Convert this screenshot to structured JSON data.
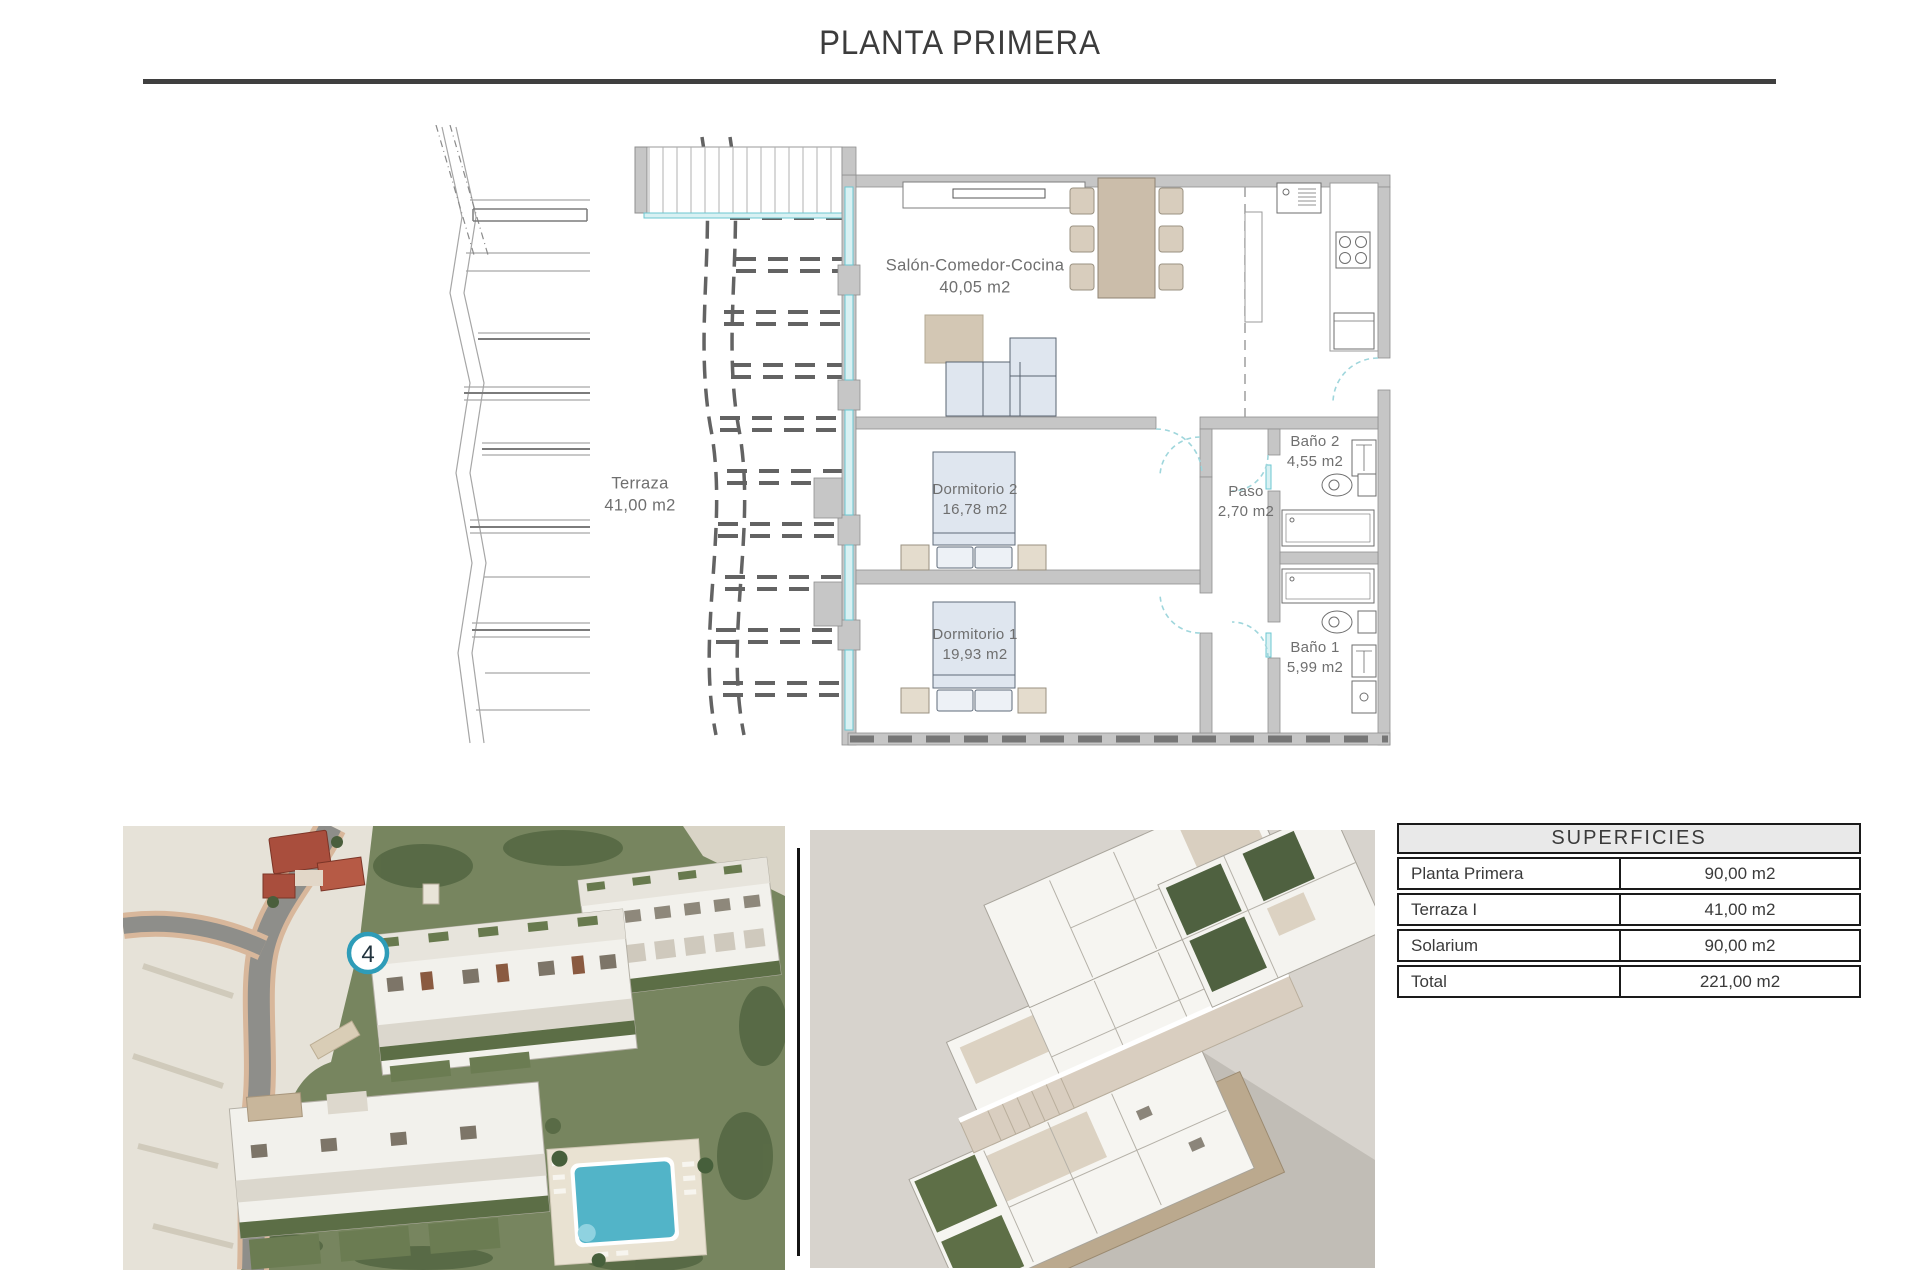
{
  "page": {
    "title": "PLANTA PRIMERA"
  },
  "floor_plan": {
    "rooms": [
      {
        "name": "Terraza",
        "area": "41,00 m2"
      },
      {
        "name": "Salón-Comedor-Cocina",
        "area": "40,05 m2"
      },
      {
        "name": "Dormitorio 2",
        "area": "16,78 m2"
      },
      {
        "name": "Dormitorio 1",
        "area": "19,93 m2"
      },
      {
        "name": "Paso",
        "area": "2,70 m2"
      },
      {
        "name": "Baño 2",
        "area": "4,55 m2"
      },
      {
        "name": "Baño 1",
        "area": "5,99 m2"
      }
    ]
  },
  "site_photo": {
    "unit_marker": "4"
  },
  "surfaces_table": {
    "header": "SUPERFICIES",
    "rows": [
      {
        "label": "Planta Primera",
        "value": "90,00 m2"
      },
      {
        "label": "Terraza I",
        "value": "41,00 m2"
      },
      {
        "label": "Solarium",
        "value": "90,00 m2"
      },
      {
        "label": "Total",
        "value": "221,00 m2"
      }
    ]
  },
  "colors": {
    "title_text": "#3c3c3c",
    "title_rule": "#3f3f3f",
    "wall_gray": "#c6c6c6",
    "glazing_cyan": "#7ed3da",
    "label_text": "#6f6f6f",
    "furniture_beige": "#d8cdbd",
    "bed_blue": "#dfe6ef",
    "marker_ring": "#2e9cb8",
    "pool_cyan": "#52b4c8",
    "vegetation_green": "#77855f",
    "render_background": "#d7d3cd",
    "table_border": "#1a1a1a",
    "table_header_bg": "#e9e9e9"
  }
}
